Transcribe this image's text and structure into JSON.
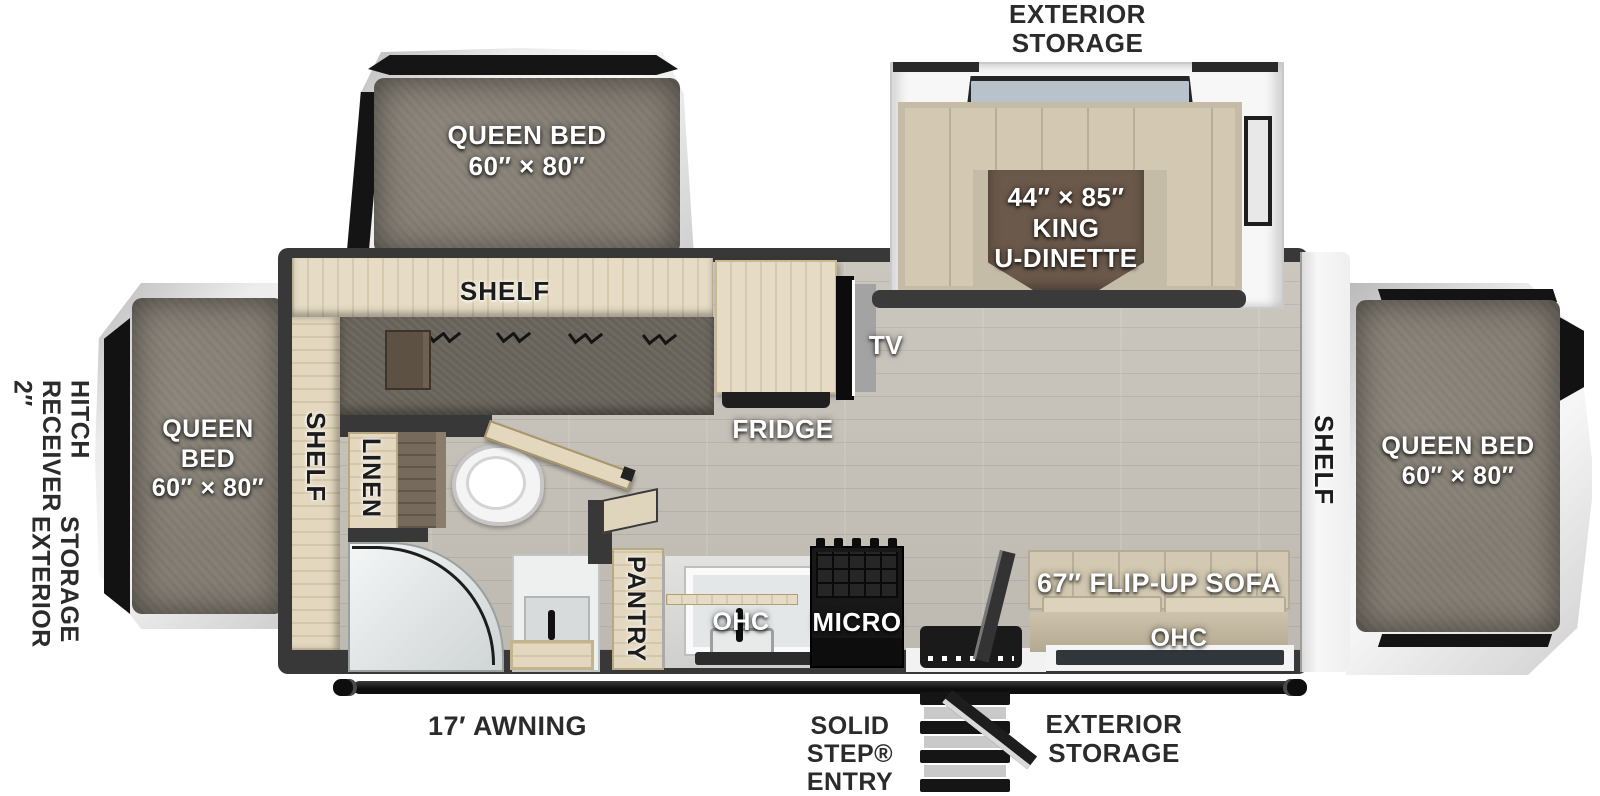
{
  "title": "Travel trailer floor plan",
  "labels": {
    "hitch": "2″\nRECEIVER\nHITCH",
    "hitch_storage": "EXTERIOR\nSTORAGE",
    "storage_top": "EXTERIOR\nSTORAGE",
    "storage_bottom": "EXTERIOR\nSTORAGE",
    "awning": "17′ AWNING",
    "entry": "SOLID\nSTEP®\nENTRY",
    "bed_front": "QUEEN\nBED\n60″ × 80″",
    "bed_top": "QUEEN BED\n60″ × 80″",
    "bed_rear": "QUEEN BED\n60″ × 80″",
    "dinette": "44″ × 85″\nKING\nU-DINETTE",
    "shelf_top": "SHELF",
    "shelf_left": "SHELF",
    "shelf_right": "SHELF",
    "linen": "LINEN",
    "pantry": "PANTRY",
    "tv": "TV",
    "fridge": "FRIDGE",
    "ohc_kitchen": "OHC",
    "micro": "MICRO",
    "sofa": "67″ FLIP-UP SOFA",
    "ohc_sofa": "OHC"
  },
  "colors": {
    "wall": "#383838",
    "floor_wood": "#c7c3bb",
    "cabinet_wood": "#e6dcc5",
    "mattress": "#867f75",
    "dinette_table": "#6b594b",
    "cushion": "#d3c9b2",
    "exterior_label": "#2b2b2b",
    "interior_label": "#ffffff"
  }
}
